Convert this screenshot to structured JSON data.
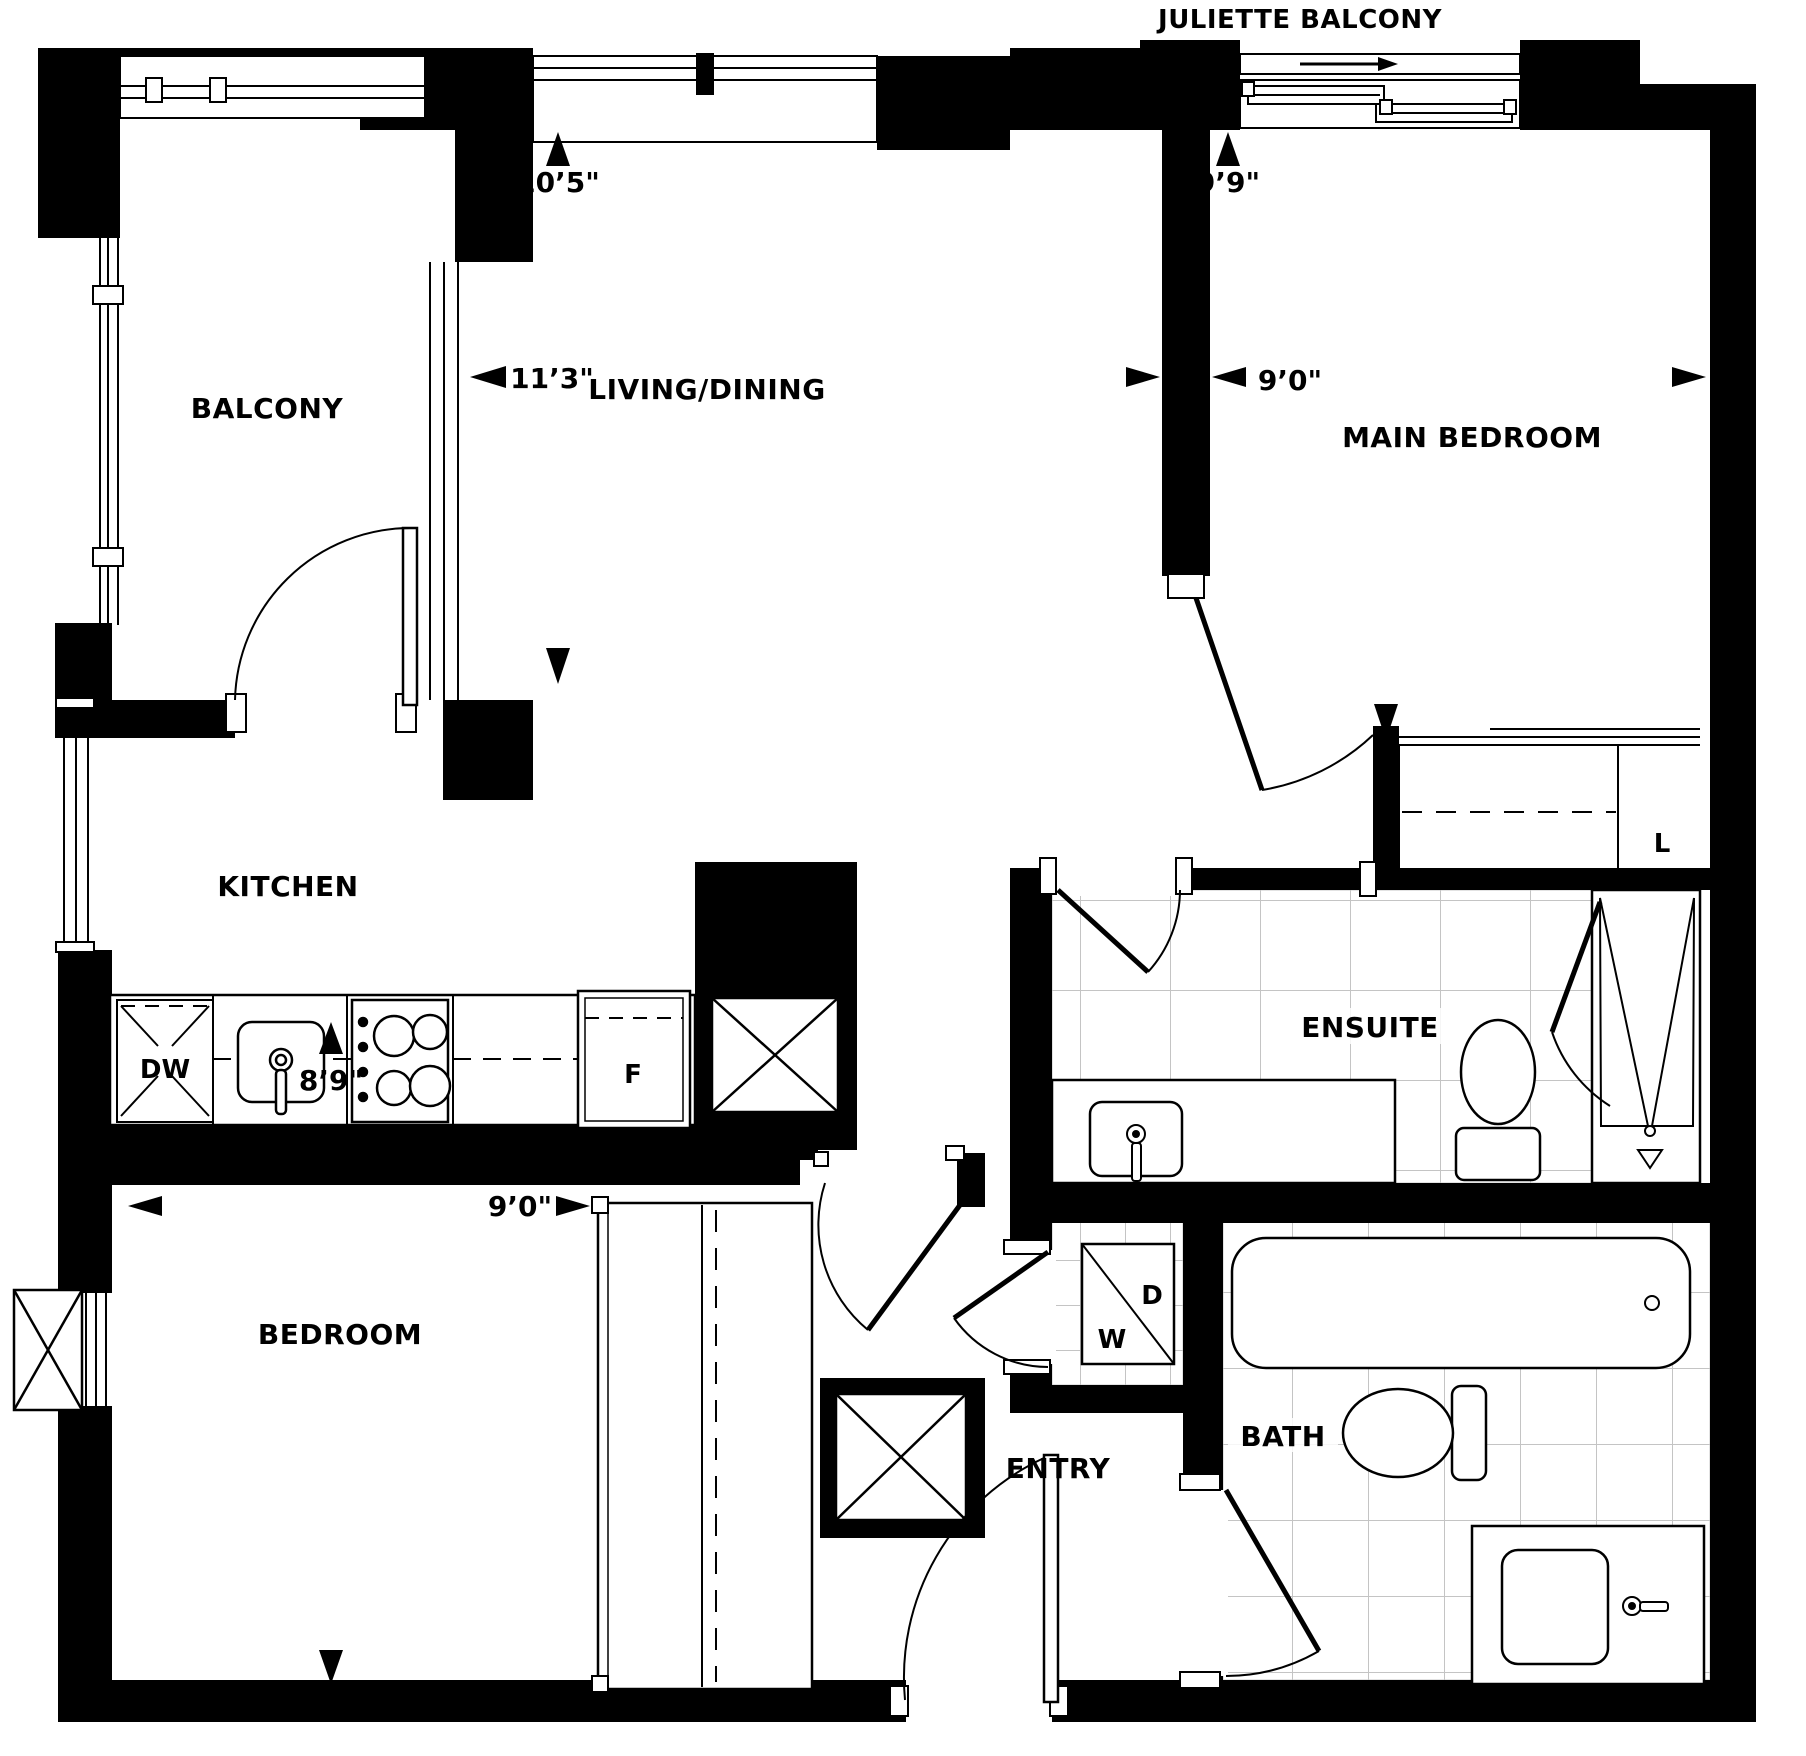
{
  "floorplan": {
    "unit_labels": {
      "juliette_balcony": "JULIETTE BALCONY",
      "balcony": "BALCONY",
      "living_dining": "LIVING/DINING",
      "main_bedroom": "MAIN BEDROOM",
      "kitchen": "KITCHEN",
      "ensuite": "ENSUITE",
      "bedroom": "BEDROOM",
      "bath": "BATH",
      "entry": "ENTRY",
      "linen_closet": "L",
      "washer": "W",
      "dryer": "D",
      "dishwasher": "DW",
      "fridge": "F"
    },
    "dimensions": {
      "living_dining_depth": "10’5\"",
      "living_dining_width": "11’3\"",
      "main_bedroom_depth": "9’9\"",
      "main_bedroom_width": "9’0\"",
      "bedroom_depth": "8’9\"",
      "bedroom_width": "9’0\""
    },
    "colors": {
      "wall": "#000000",
      "tile_line": "#c4c4c4",
      "background": "#ffffff"
    }
  }
}
